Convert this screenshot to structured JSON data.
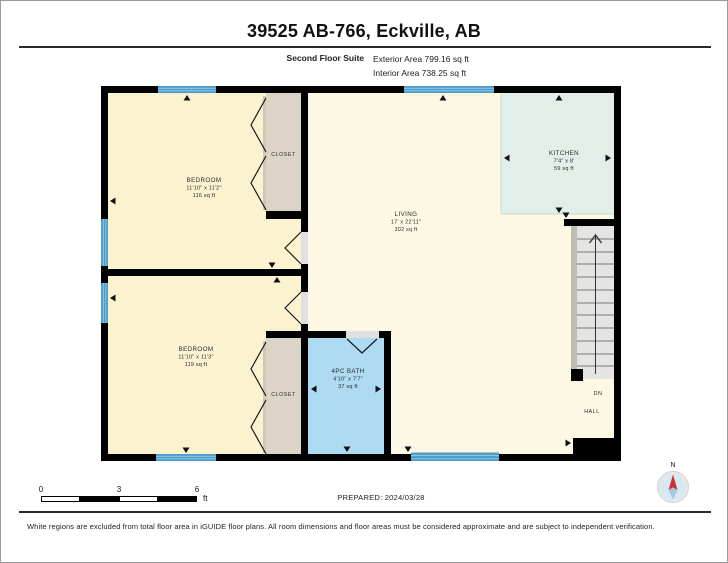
{
  "header": {
    "title": "39525 AB-766, Eckville, AB",
    "floor_label": "Second Floor Suite",
    "exterior_area": "Exterior Area 799.16 sq ft",
    "interior_area": "Interior Area 738.25 sq ft"
  },
  "rooms": {
    "bedroom1": {
      "name": "BEDROOM",
      "dims": "11'10\" x 11'2\"",
      "area": "116 sq ft"
    },
    "bedroom2": {
      "name": "BEDROOM",
      "dims": "11'10\" x 11'3\"",
      "area": "119 sq ft"
    },
    "living": {
      "name": "LIVING",
      "dims": "17' x 22'11\"",
      "area": "302 sq ft"
    },
    "kitchen": {
      "name": "KITCHEN",
      "dims": "7'4\" x 8'",
      "area": "59 sq ft"
    },
    "bath": {
      "name": "4PC BATH",
      "dims": "4'10\" x 7'7\"",
      "area": "37 sq ft"
    },
    "closet_top": {
      "name": "CLOSET"
    },
    "closet_bottom": {
      "name": "CLOSET"
    },
    "stairs": {
      "direction_label": "DN"
    },
    "hall": {
      "name": "HALL"
    }
  },
  "scale_bar": {
    "tick0": "0",
    "tick3": "3",
    "tick6": "6",
    "unit": "ft"
  },
  "compass": {
    "north_label": "N"
  },
  "footer": {
    "prepared": "PREPARED: 2024/03/28",
    "disclaimer": "White regions are excluded from total floor area in iGUIDE floor plans. All room dimensions and floor areas must be considered approximate and are subject to independent verification."
  },
  "colors": {
    "wall": "#000000",
    "bedroom": "#FBF2D0",
    "living": "#FCF8E3",
    "kitchen": "#E2EFE8",
    "bath": "#AEDAF2",
    "closet": "#DCD4C6",
    "closet_track": "#CFC8BA",
    "stairs": "#E4E4E2",
    "stringer": "#BDBDB5",
    "window": "#4D9DCC",
    "window_stripe": "#8FC4E2",
    "door_gap": "#E0E0E0",
    "compass_face": "#D8E8F3",
    "compass_red": "#C8332E",
    "compass_blue": "#A9C6DB"
  }
}
